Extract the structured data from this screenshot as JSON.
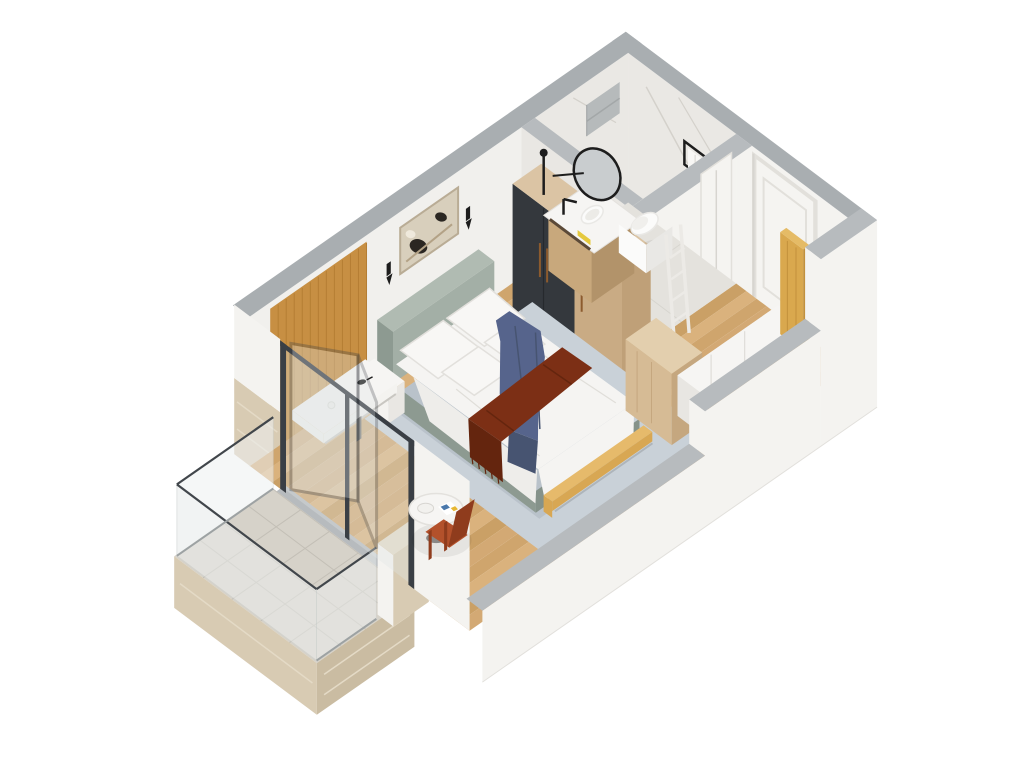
{
  "scene": {
    "type": "isometric-3d-floorplan-render",
    "title_visible_text": "",
    "rooms": [
      {
        "name": "bedroom",
        "items": [
          "wood-accent-wall",
          "wall-art",
          "wall-sconce",
          "wall-sconce",
          "console-desk",
          "bird-figurine",
          "vase",
          "nightstand",
          "double-bed",
          "headboard",
          "pillows",
          "duvet",
          "throw-blanket-blue",
          "throw-runner-red",
          "foot-bench-rail",
          "area-rug",
          "wardrobe",
          "coffee-table",
          "plate",
          "magazine",
          "lounge-chair",
          "wood-floor"
        ],
        "pillow_count": 4
      },
      {
        "name": "bathroom",
        "items": [
          "marble-wall",
          "shower-niche",
          "vanity-counter",
          "vessel-sink",
          "round-mirror",
          "wall-lamp",
          "yellow-towel",
          "toilet",
          "towel-ladder",
          "towel-frame",
          "bathroom-door"
        ]
      },
      {
        "name": "entry-hall",
        "items": [
          "entry-door",
          "hall-closet",
          "dresser-cube",
          "oak-panel",
          "wood-floor"
        ]
      },
      {
        "name": "balcony",
        "items": [
          "tile-floor",
          "glass-balustrade",
          "handrail",
          "travertine-wall",
          "sliding-glass-door",
          "open-door-leaf",
          "threshold"
        ]
      }
    ]
  },
  "colors": {
    "bg": "#ffffff",
    "wallWhite": "#f1f0ed",
    "wallWhite2": "#f4f3f0",
    "wallShade": "#e9e7e3",
    "bandGray": "#a9aeb1",
    "bandLight": "#b7bbbe",
    "marble": "#eae8e4",
    "marbleVein": "#d4d1cb",
    "nicheGray": "#b6babb",
    "floorA": "#d3a974",
    "floorB": "#caa066",
    "floorC": "#dab27d",
    "floorD": "#cfa56d",
    "woodPanel": "#c78f43",
    "woodPanelLine": "#b57e34",
    "wardWoodSide": "#bfa078",
    "wardWoodTop": "#dbc4a4",
    "wardWoodDoor": "#c9ab84",
    "wardDark": "#34383d",
    "handle": "#8c5b2e",
    "closetWhite": "#f3f2ef",
    "closetEnd": "#e8e6e2",
    "closetSeam": "#dfddd8",
    "dresserTop": "#e3cfae",
    "dresserFront": "#d6bb95",
    "dresserSide": "#c5a77f",
    "oak": "#d9a84e",
    "oakSide": "#c2913c",
    "oakTop": "#e5bb66",
    "doorWhite": "#f5f4f1",
    "doorFrame": "#e2e0db",
    "doorShadow": "#d7d5d0",
    "frameDark": "#3a3f45",
    "glass": "#dfe5e6",
    "glassBal": "#eef1f1",
    "railDark": "#41464b",
    "tile": "#d6d2c9",
    "grout": "#c3bfb6",
    "trav": "#d8cbb3",
    "travDark": "#cabca2",
    "travLight": "#e4dac6",
    "rug": "#c9d1d8",
    "rugShade": "#b9c2ca",
    "sage": "#a3afa6",
    "sageDark": "#8d9a91",
    "sageDark2": "#85928a",
    "sageTop": "#b0bbb2",
    "bedWhite": "#f5f4f2",
    "bedShade": "#eeedea",
    "bedShade2": "#e0ded9",
    "pillow": "#f8f7f5",
    "pillowEdge": "#e2e0dc",
    "blue": "#56648c",
    "blueDark": "#475471",
    "red": "#7c2f15",
    "redDark": "#64250e",
    "bench": "#d8a753",
    "benchTop": "#e6ba6b",
    "tableWhite": "#f6f5f3",
    "tableEdge": "#e3e1dd",
    "leg": "#706e6a",
    "chair": "#b3512b",
    "chairDark": "#8f3c1d",
    "consoleWhite": "#f4f3f0",
    "consoleShade": "#c9c7c2",
    "art": "#d8cfbc",
    "artFrame": "#b9ac95",
    "artDark": "#2b2722",
    "artMid": "#b3a286",
    "black": "#1d1d1d",
    "porcelain": "#fbfbfa",
    "porcelainShade": "#e9e8e5",
    "counterWood": "#c8a87c",
    "counterWoodDark": "#b2936a",
    "towelYellow": "#e5c93e",
    "mirrorGlass": "#c9cdcf",
    "ladderWhite": "#eceae6",
    "bathFloor": "#e4e2dd",
    "bathFloorLine": "#d7d5cf",
    "shadow": "rgba(0,0,0,0.06)"
  }
}
